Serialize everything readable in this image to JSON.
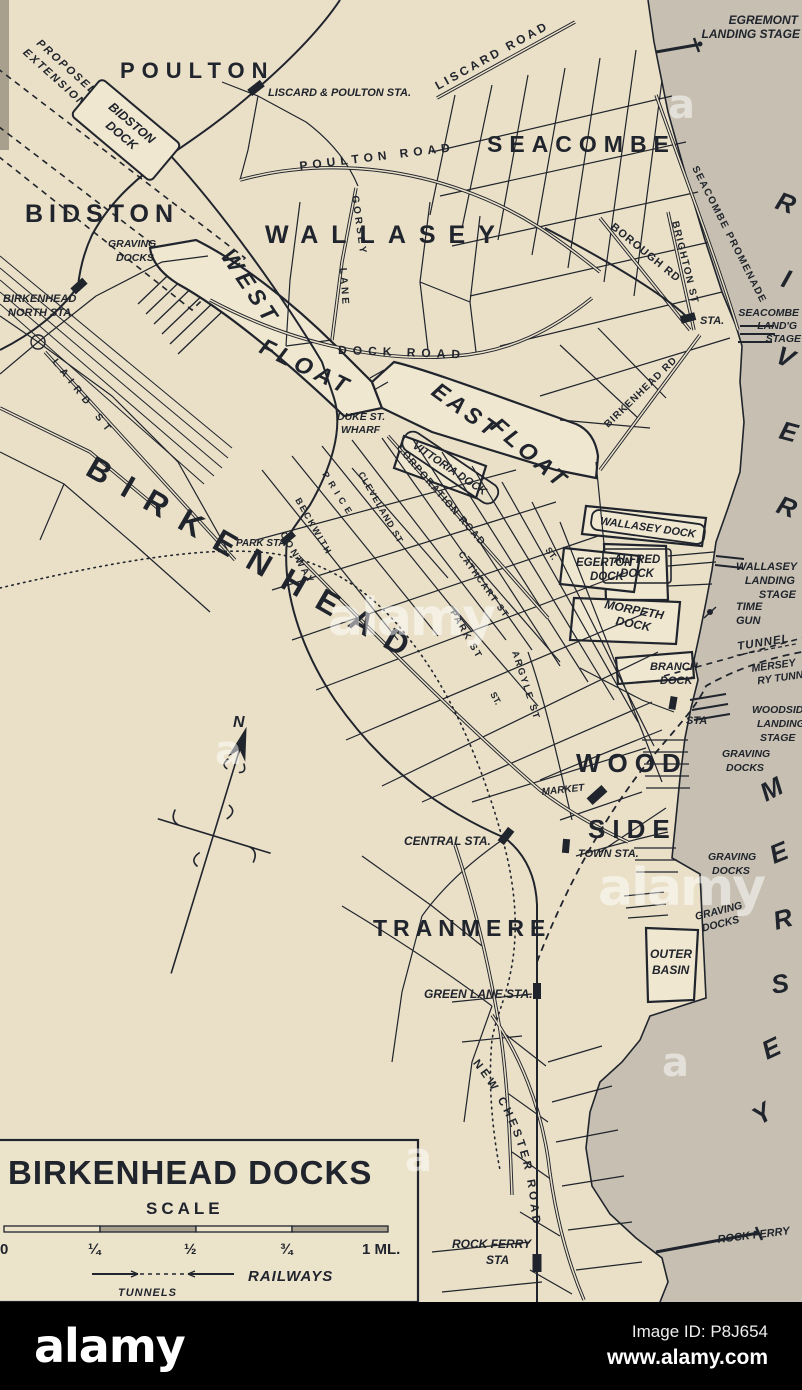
{
  "colors": {
    "paper": "#eae0c8",
    "dock_water": "#f0e7d1",
    "river": "#c7c0b2",
    "ink": "#20242c",
    "footer_bar": "#000000",
    "watermark": "rgba(255,255,255,0.5)"
  },
  "labels": {
    "compass_n": "N",
    "poulton": "POULTON",
    "bidston": "BIDSTON",
    "wallasey": "WALLASEY",
    "seacombe": "SEACOMBE",
    "tranmere": "TRANMERE",
    "wood": "WOOD",
    "side": "SIDE",
    "birkenhead": "BIRKENHEAD",
    "west": [
      "WEST",
      "FLOAT"
    ],
    "east": [
      "EAST",
      "FLOAT"
    ],
    "river": [
      "R",
      "I",
      "V",
      "E",
      "R"
    ],
    "mersey": [
      "M",
      "E",
      "R",
      "S",
      "E",
      "Y"
    ],
    "liscard_poulton_sta": "LISCARD & POULTON STA.",
    "birkenhead_north_sta": [
      "BIRKENHEAD",
      "NORTH STA."
    ],
    "graving_bidston": [
      "GRAVING",
      "DOCKS"
    ],
    "park_sta": "PARK STA.",
    "central_sta": "CENTRAL STA.",
    "town_sta": "TOWN STA.",
    "market": "MARKET",
    "green_lane_sta": "GREEN LANE STA.",
    "rock_ferry_sta": [
      "ROCK FERRY",
      "STA"
    ],
    "rock_ferry": "ROCK FERRY",
    "egremont": [
      "EGREMONT",
      "LANDING STAGE"
    ],
    "seacombe_stage": [
      "SEACOMBE",
      "LAND'G",
      "STAGE"
    ],
    "seacombe_sta": "STA.",
    "wallasey_stage": [
      "WALLASEY",
      "LANDING",
      "STAGE"
    ],
    "time_gun": [
      "TIME",
      "GUN"
    ],
    "tunnel": "TUNNEL",
    "mersey_ry": [
      "MERSEY",
      "RY TUNNEL"
    ],
    "woodside_stage": [
      "WOODSIDE",
      "LANDING",
      "STAGE"
    ],
    "woodside_sta": "STA",
    "graving_1": [
      "GRAVING",
      "DOCKS"
    ],
    "graving_2": [
      "GRAVING",
      "DOCKS"
    ],
    "graving_3": [
      "GRAVING",
      "DOCKS"
    ],
    "outer_basin": [
      "OUTER",
      "BASIN"
    ],
    "branch_dock": [
      "BRANCH",
      "DOCK"
    ],
    "duke": [
      "DUKE ST.",
      "WHARF"
    ],
    "proposed": [
      "PROPOSED",
      "EXTENSION"
    ],
    "bidston_dock": [
      "BIDSTON",
      "DOCK"
    ],
    "vittoria_dock": "VITTORIA DOCK",
    "wallasey_dock": "WALLASEY DOCK",
    "alfred_dock": [
      "ALFRED",
      "DOCK"
    ],
    "egerton_dock": [
      "EGERTON",
      "DOCK"
    ],
    "morpeth_dock": [
      "MORPETH",
      "DOCK"
    ],
    "liscard_road": "LISCARD ROAD",
    "poulton_road": "POULTON ROAD",
    "gorsey": [
      "GORSEY",
      "LANE"
    ],
    "dock_road": "DOCK ROAD",
    "brighton_st": "BRIGHTON ST",
    "promenade": "SEACOMBE PROMENADE",
    "borough_rd": "BOROUGH RD",
    "birkenhead_rd": "BIRKENHEAD RD",
    "corporation_road": "CORPORATION ROAD",
    "cleveland_st": "CLEVELAND ST",
    "laird_st": "LAIRD ST",
    "price": "PRICE",
    "beckwith": "BECKWITH",
    "conway": "CONWAY",
    "cathcart": "CATHCART ST",
    "park_st": "PARK ST",
    "argyle": "ARGYLE ST",
    "st1": "ST.",
    "st2": "ST.",
    "new_chester_road": "NEW CHESTER ROAD"
  },
  "legend": {
    "title": "BIRKENHEAD DOCKS",
    "scale_label": "SCALE",
    "ticks": [
      "0",
      "¼",
      "½",
      "¾",
      "1 ML."
    ],
    "railways": "RAILWAYS",
    "tunnels": "TUNNELS"
  },
  "watermark": {
    "brand": "alamy",
    "letter": "a"
  },
  "footer": {
    "logo": "alamy",
    "image_id": "Image ID: P8J654",
    "url": "www.alamy.com"
  }
}
